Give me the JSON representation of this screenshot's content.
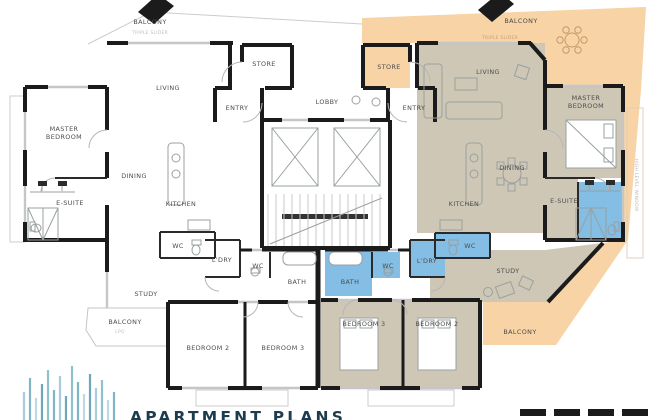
{
  "document": {
    "type": "apartment-floor-plan",
    "background": "#ffffff"
  },
  "colors": {
    "balcony_peach": "#f7d3a6",
    "room_beige": "#cec7b6",
    "wet_area_blue": "#84bee5",
    "wall_black": "#1b1b1b",
    "label_gray": "#4c4c4c",
    "annotation_gray": "#bdbdbd",
    "logo_teal": "#7fb5c4",
    "logo_navy": "#1d3d4f"
  },
  "labels": {
    "lobby": "LOBBY",
    "left": {
      "balcony_top": "BALCONY",
      "living": "LIVING",
      "store": "STORE",
      "entry": "ENTRY",
      "master_1": "MASTER",
      "master_2": "BEDROOM",
      "esuite": "E-SUITE",
      "dining": "DINING",
      "kitchen": "KITCHEN",
      "wc_a": "WC",
      "ldry": "L'DRY",
      "wc_b": "WC",
      "bath": "BATH",
      "study": "STUDY",
      "balcony_bottom": "BALCONY",
      "bedroom2": "BEDROOM 2",
      "bedroom3": "BEDROOM 3"
    },
    "right": {
      "balcony_top": "BALCONY",
      "store": "STORE",
      "entry": "ENTRY",
      "living": "LIVING",
      "master_1": "MASTER",
      "master_2": "BEDROOM",
      "esuite": "E-SUITE",
      "dining": "DINING",
      "kitchen": "KITCHEN",
      "wc_a": "WC",
      "ldry": "L'DRY",
      "wc_b": "WC",
      "bath": "BATH",
      "study": "STUDY",
      "bedroom3": "BEDROOM 3",
      "bedroom2": "BEDROOM 2",
      "balcony_bottom": "BALCONY"
    },
    "annotations": {
      "slider_left": "TRIPLE SLIDER",
      "slider_right": "TRIPLE SLIDER",
      "lpo": "LPO",
      "high_window": "HIGH LEVEL WINDOW"
    }
  },
  "logo": {
    "text": "APARTMENT PLANS"
  }
}
